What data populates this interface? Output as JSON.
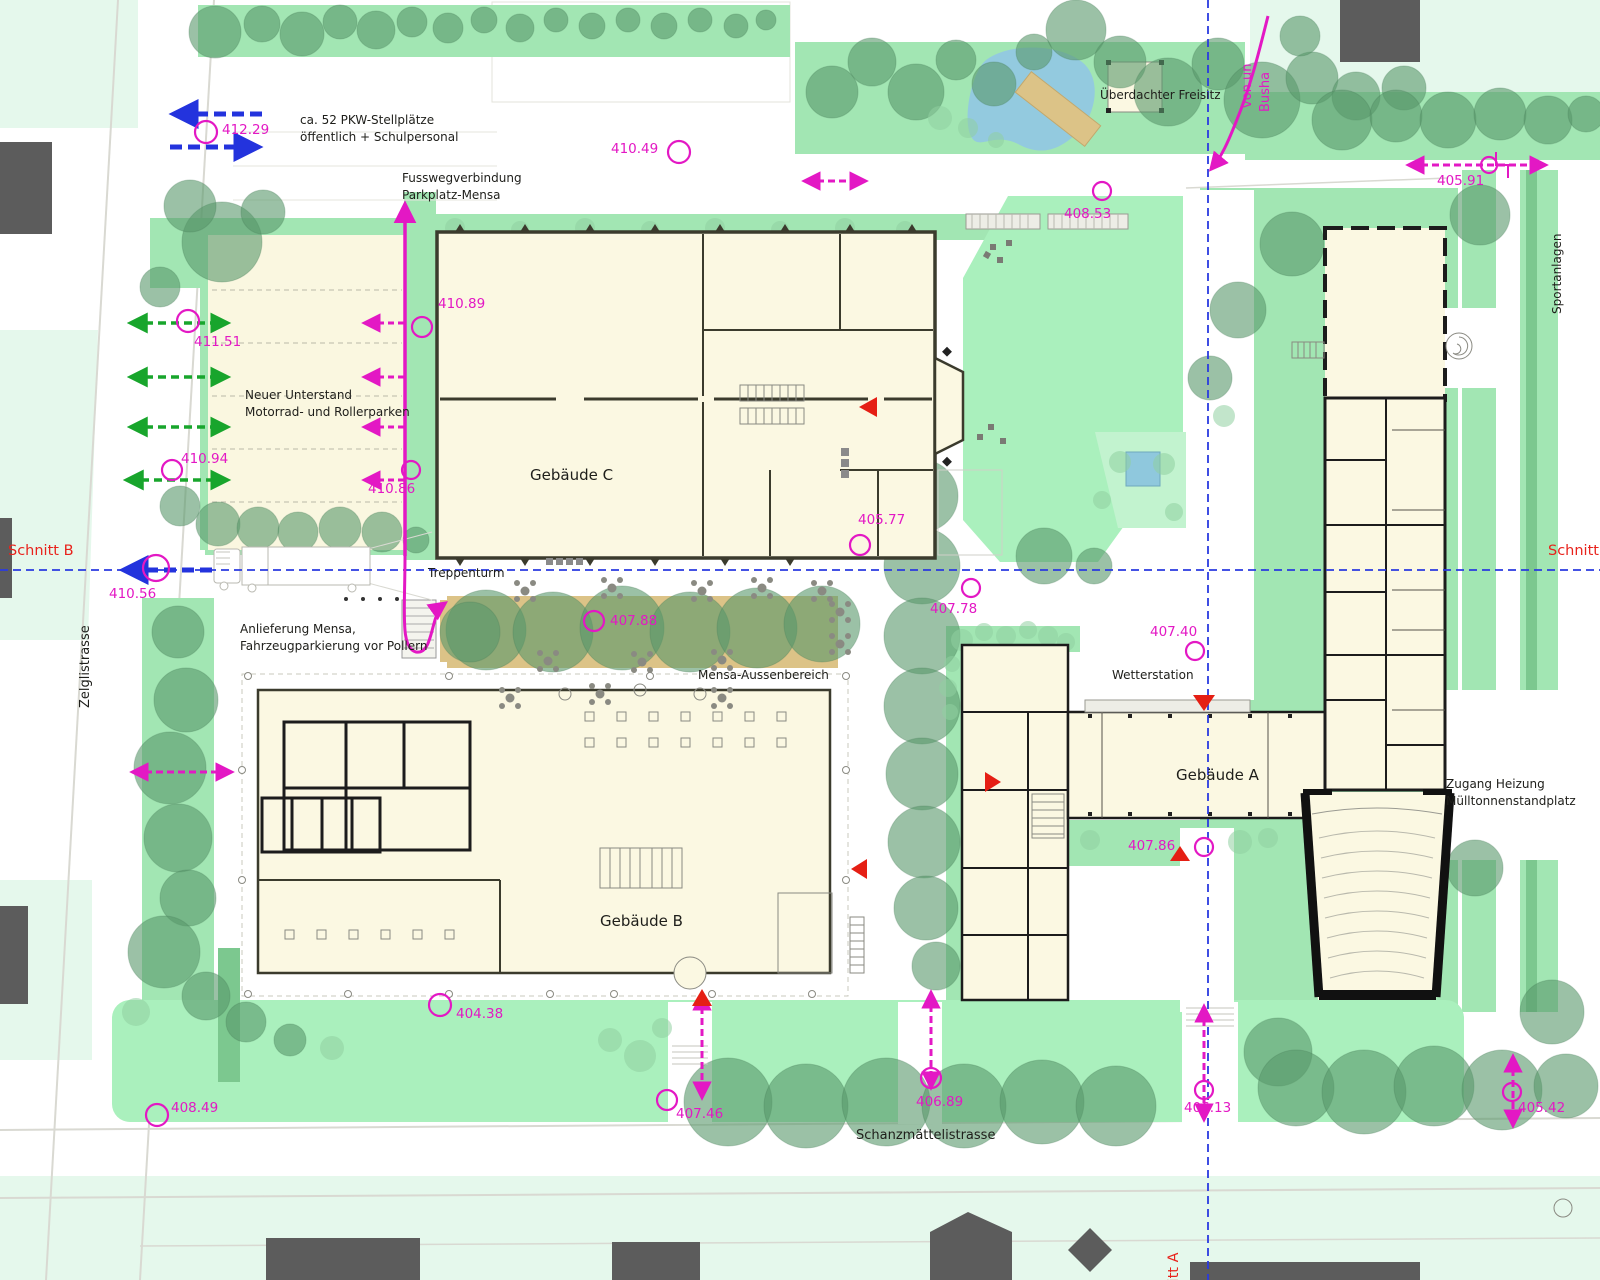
{
  "streets": {
    "zelglistrasse": "Zelglistrasse",
    "schanzmaettelistrasse": "Schanzmättelistrasse",
    "sportanlagen": "Sportanlagen"
  },
  "sections": {
    "schnitt_b_left": "Schnitt B",
    "schnitt_b_right": "Schnitt B",
    "schnitt_a": "Schnitt A"
  },
  "buildings": {
    "a": "Gebäude A",
    "b": "Gebäude B",
    "c": "Gebäude C"
  },
  "labels": {
    "pkw_line1": "ca. 52 PKW-Stellplätze",
    "pkw_line2": "öffentlich + Schulpersonal",
    "fussweg_line1": "Fusswegverbindung",
    "fussweg_line2": "Parkplatz-Mensa",
    "unterstand_line1": "Neuer Unterstand",
    "unterstand_line2": "Motorrad- und Rollerparken",
    "freisitz": "Überdachter Freisitz",
    "anlieferung_line1": "Anlieferung Mensa,",
    "anlieferung_line2": "Fahrzeugparkierung vor Pollern",
    "treppenturm": "Treppenturm",
    "mensa_aussenbereich": "Mensa-Aussenbereich",
    "wetterstation": "Wetterstation",
    "zugang_line1": "Zugang Heizung",
    "zugang_line2": "Mülltonnenstandplatz",
    "bus_line1": "von un",
    "bus_line2": "Busha"
  },
  "elevations": {
    "p412_29": "412.29",
    "p410_49": "410.49",
    "p408_53": "408.53",
    "p405_91": "405.91",
    "p411_51": "411.51",
    "p410_89": "410.89",
    "p410_94": "410.94",
    "p410_86": "410.86",
    "p405_77": "405.77",
    "p410_56": "410.56",
    "p407_88": "407.88",
    "p407_78": "407.78",
    "p407_40": "407.40",
    "p407_86": "407.86",
    "p404_38": "404.38",
    "p408_49": "408.49",
    "p407_46": "407.46",
    "p406_89": "406.89",
    "p406_13": "406.13",
    "p405_42": "405.42"
  },
  "colors": {
    "magenta": "#e318c4",
    "section_blue": "#2a3ae0",
    "arrow_green": "#18a52c",
    "entrance_red": "#e51f14",
    "lawn": "#a2e6b3",
    "field": "#aaf0bd",
    "tree": "#59976b",
    "building_fill": "#fbf8e2",
    "wall": "#3b3b2d",
    "terrace_tan": "#dcc387",
    "pond_blue": "#93cadf",
    "neighbor_building": "#5c5c5c",
    "parcel": "#e5f8ec"
  }
}
